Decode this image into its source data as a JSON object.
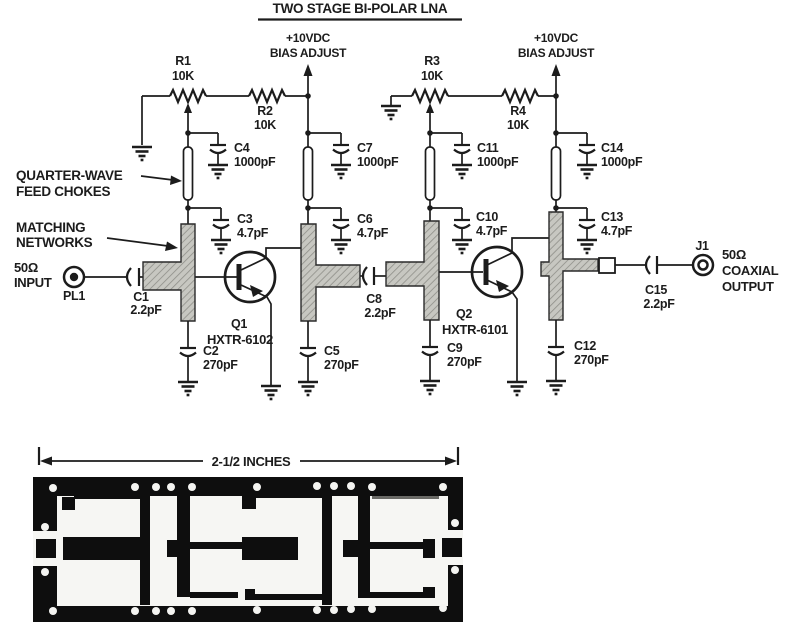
{
  "title": "TWO STAGE BI-POLAR LNA",
  "schematic": {
    "bias": {
      "line1": "+10VDC",
      "line2": "BIAS ADJUST"
    },
    "annotations": {
      "chokes1": "QUARTER-WAVE",
      "chokes2": "FEED CHOKES",
      "matching1": "MATCHING",
      "matching2": "NETWORKS"
    },
    "input": {
      "impedance": "50Ω",
      "label": "INPUT",
      "connector": "PL1"
    },
    "output": {
      "connector": "J1",
      "impedance": "50Ω",
      "line1": "COAXIAL",
      "line2": "OUTPUT"
    },
    "resistors": {
      "r1": {
        "ref": "R1",
        "value": "10K"
      },
      "r2": {
        "ref": "R2",
        "value": "10K"
      },
      "r3": {
        "ref": "R3",
        "value": "10K"
      },
      "r4": {
        "ref": "R4",
        "value": "10K"
      }
    },
    "capacitors": {
      "c1": {
        "ref": "C1",
        "value": "2.2pF"
      },
      "c2": {
        "ref": "C2",
        "value": "270pF"
      },
      "c3": {
        "ref": "C3",
        "value": "4.7pF"
      },
      "c4": {
        "ref": "C4",
        "value": "1000pF"
      },
      "c5": {
        "ref": "C5",
        "value": "270pF"
      },
      "c6": {
        "ref": "C6",
        "value": "4.7pF"
      },
      "c7": {
        "ref": "C7",
        "value": "1000pF"
      },
      "c8": {
        "ref": "C8",
        "value": "2.2pF"
      },
      "c9": {
        "ref": "C9",
        "value": "270pF"
      },
      "c10": {
        "ref": "C10",
        "value": "4.7pF"
      },
      "c11": {
        "ref": "C11",
        "value": "1000pF"
      },
      "c12": {
        "ref": "C12",
        "value": "270pF"
      },
      "c13": {
        "ref": "C13",
        "value": "4.7pF"
      },
      "c14": {
        "ref": "C14",
        "value": "1000pF"
      },
      "c15": {
        "ref": "C15",
        "value": "2.2pF"
      }
    },
    "transistors": {
      "q1": {
        "ref": "Q1",
        "part": "HXTR-6102"
      },
      "q2": {
        "ref": "Q2",
        "part": "HXTR-6101"
      }
    }
  },
  "pcb": {
    "dimension": "2-1/2 INCHES"
  },
  "colors": {
    "ink": "#1c1c1c",
    "board": "#0e0e0e",
    "hatch": "#c7c7c1",
    "paper": "#ffffff"
  }
}
